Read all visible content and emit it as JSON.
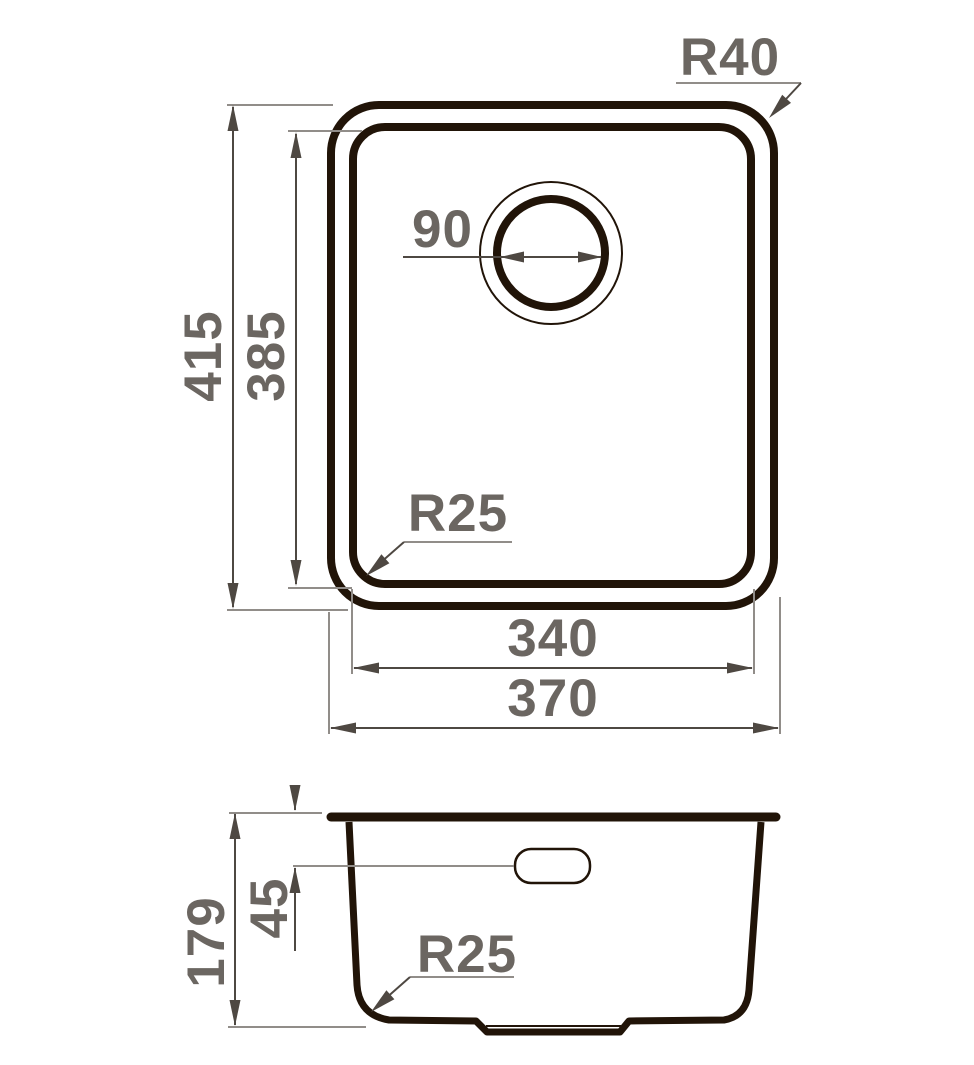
{
  "drawing": {
    "type_label": "sink-dimension-drawing",
    "views": {
      "top": {
        "corner_radius_outer": "R40",
        "drain_diameter": "90",
        "outer_height": "415",
        "inner_height": "385",
        "corner_radius_inner": "R25",
        "inner_width": "340",
        "outer_width": "370"
      },
      "side": {
        "total_height": "179",
        "overflow_offset": "45",
        "bottom_corner_radius": "R25"
      }
    }
  },
  "colors": {
    "outline": "#211408",
    "dim": "#4e4842",
    "ext": "#918d89",
    "label": "#6b6661",
    "bg": "#ffffff"
  }
}
